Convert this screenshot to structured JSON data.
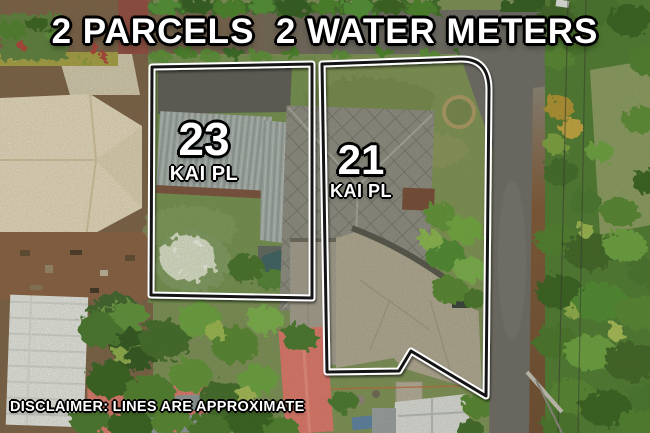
{
  "overlay": {
    "title": "2 PARCELS  2 WATER METERS",
    "parcels": [
      {
        "number": "23",
        "street": "KAI PL"
      },
      {
        "number": "21",
        "street": "KAI PL"
      }
    ],
    "disclaimer": "DISCLAIMER: LINES ARE APPROXIMATE"
  },
  "colors": {
    "boundary_casing": "#ffffff",
    "boundary_core": "#141414",
    "label_text": "#ffffff",
    "label_outline": "#000000",
    "lawn_green": "#74904e",
    "roof_23": "#a7aeac",
    "roof_21": "#8e8b83",
    "driveway_concrete": "#b2a893",
    "road_asphalt": "#6e6a66"
  }
}
